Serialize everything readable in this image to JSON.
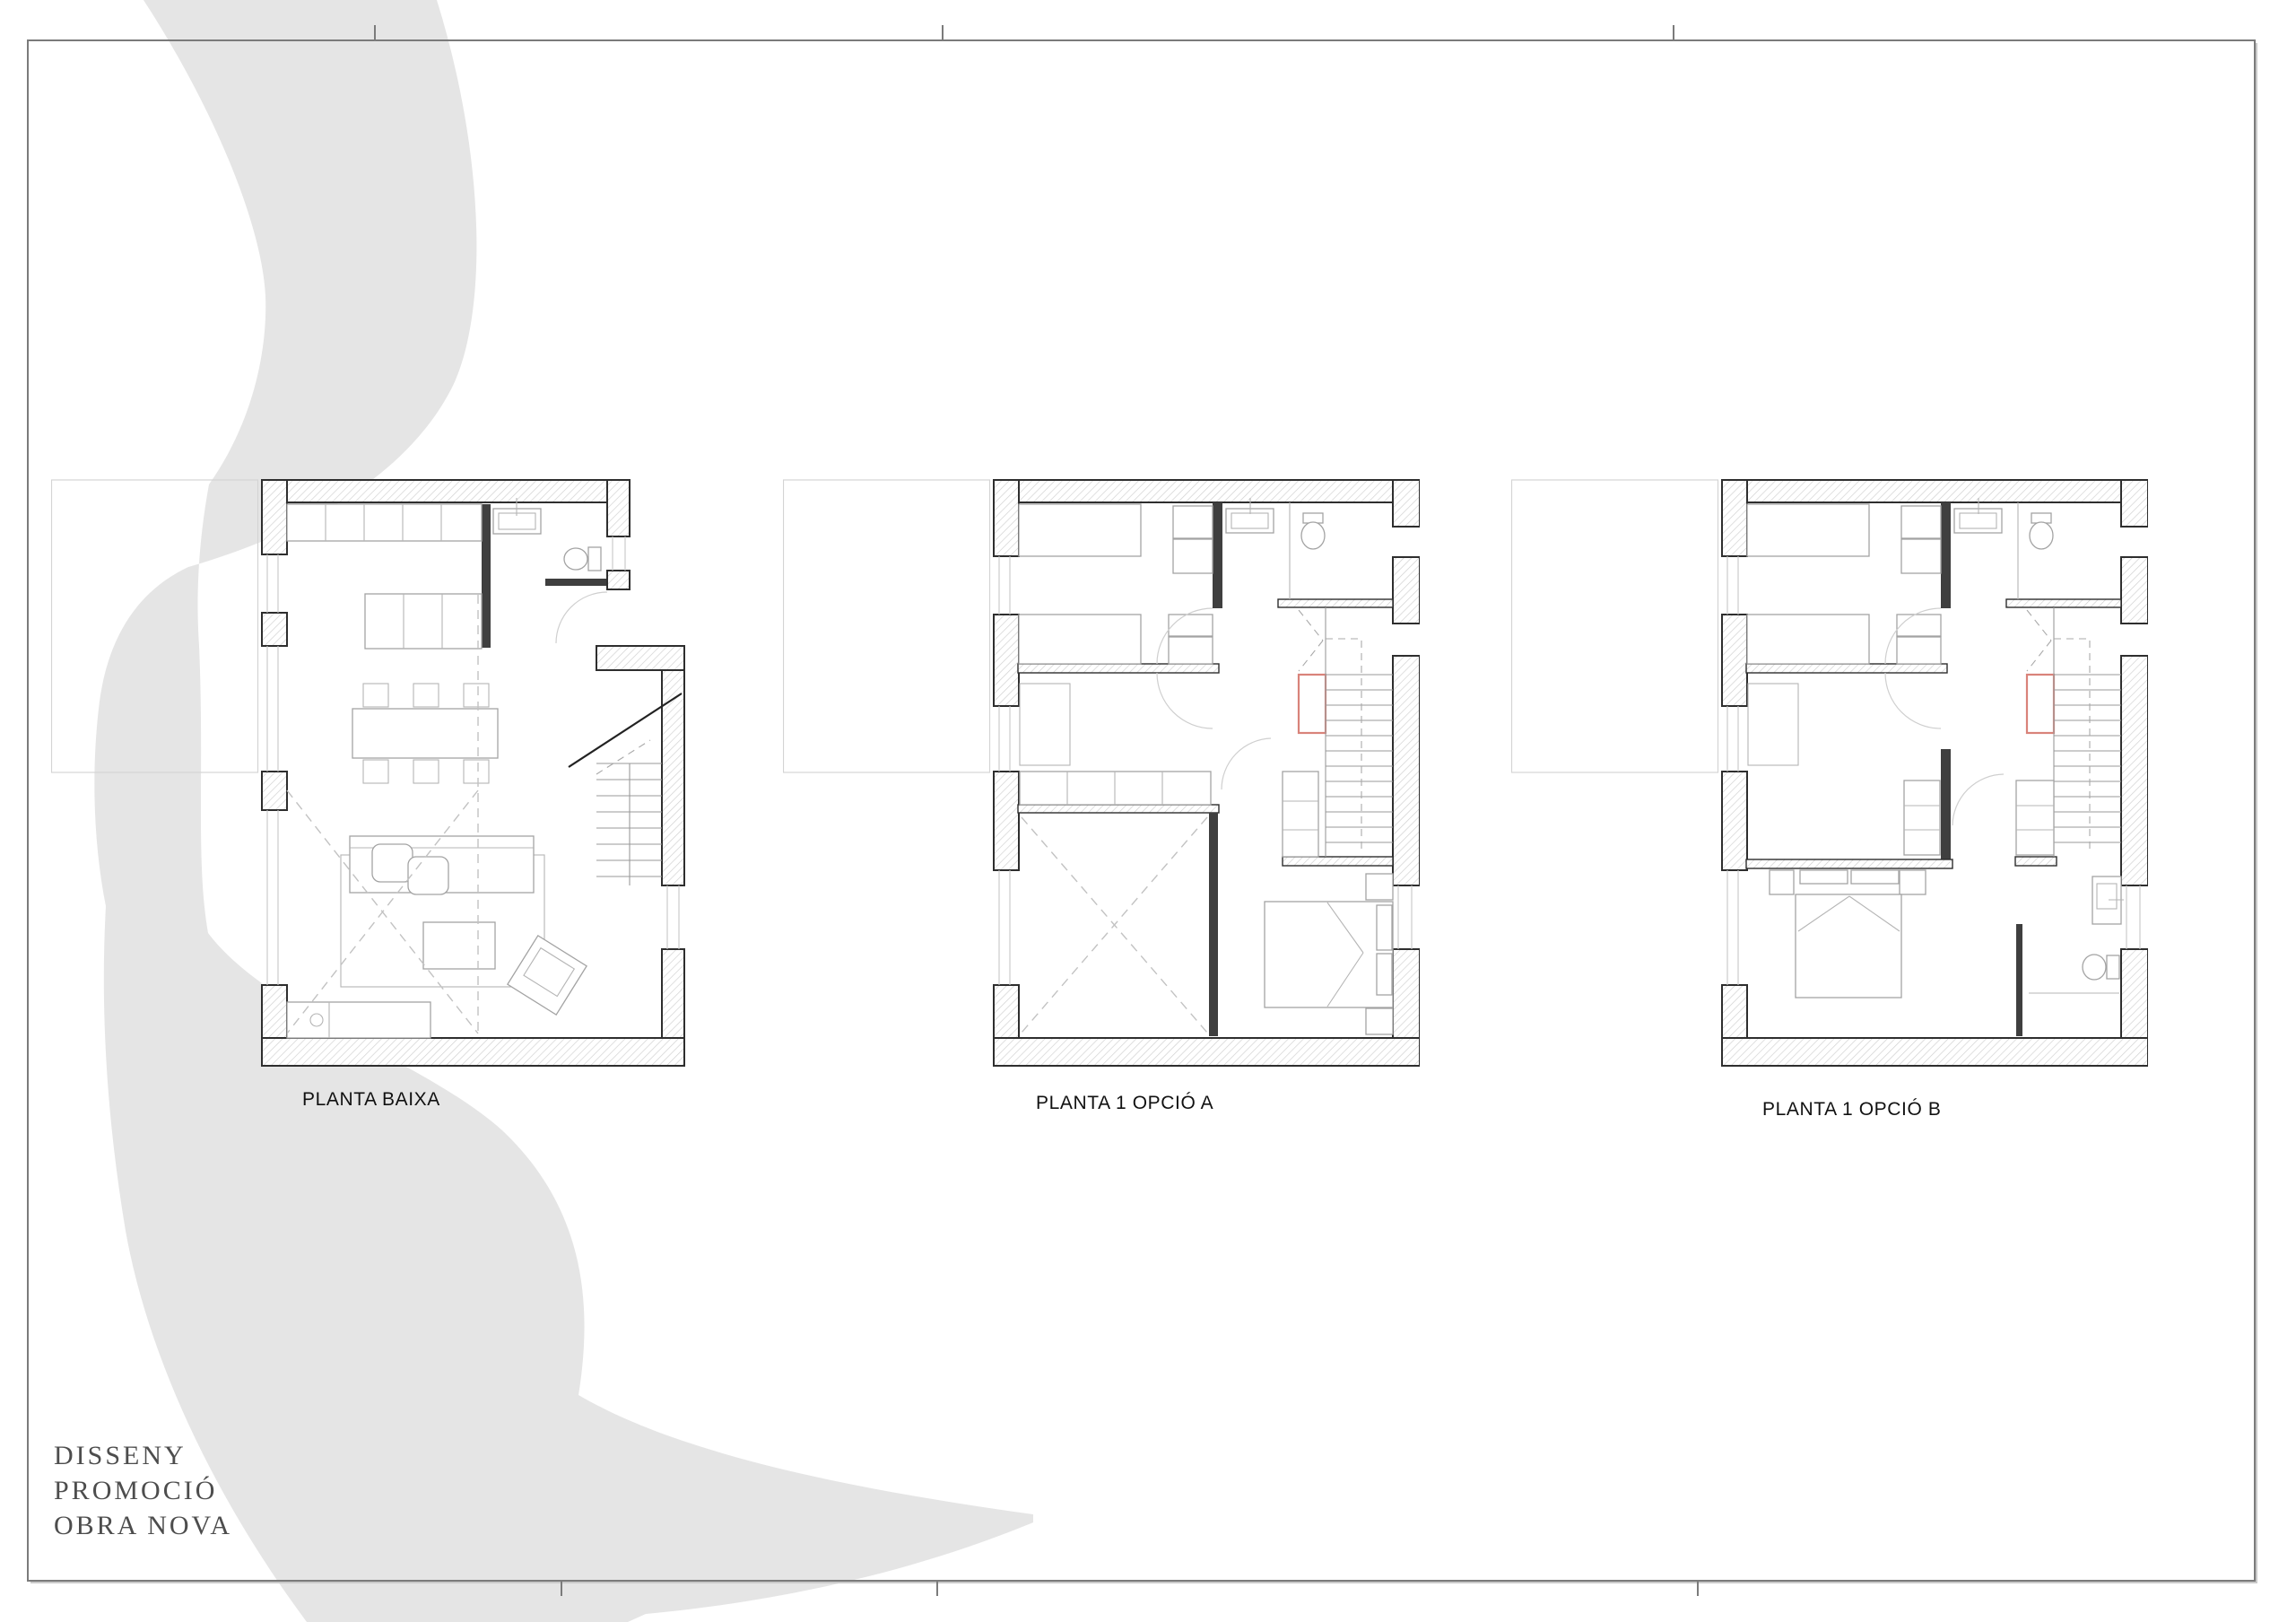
{
  "brand": {
    "lines": [
      "DISSENY",
      "PROMOCIÓ",
      "OBRA NOVA"
    ]
  },
  "plans": [
    {
      "id": "planta-baixa",
      "label": "PLANTA BAIXA"
    },
    {
      "id": "planta-1-opcio-a",
      "label": "PLANTA 1 OPCIÓ A"
    },
    {
      "id": "planta-1-opcio-b",
      "label": "PLANTA 1 OPCIÓ B"
    }
  ],
  "colors": {
    "watermark": "#e5e5e5",
    "frame": "#7b7b7b",
    "wall_outline": "#2e2e2e",
    "hatch_line": "#cfcfcf",
    "furniture_line": "#a3a3a3",
    "dashed_line": "#c2c2c2",
    "accent_red": "#d9837a",
    "label_text": "#111111",
    "brand_text": "#4d4d4d"
  }
}
